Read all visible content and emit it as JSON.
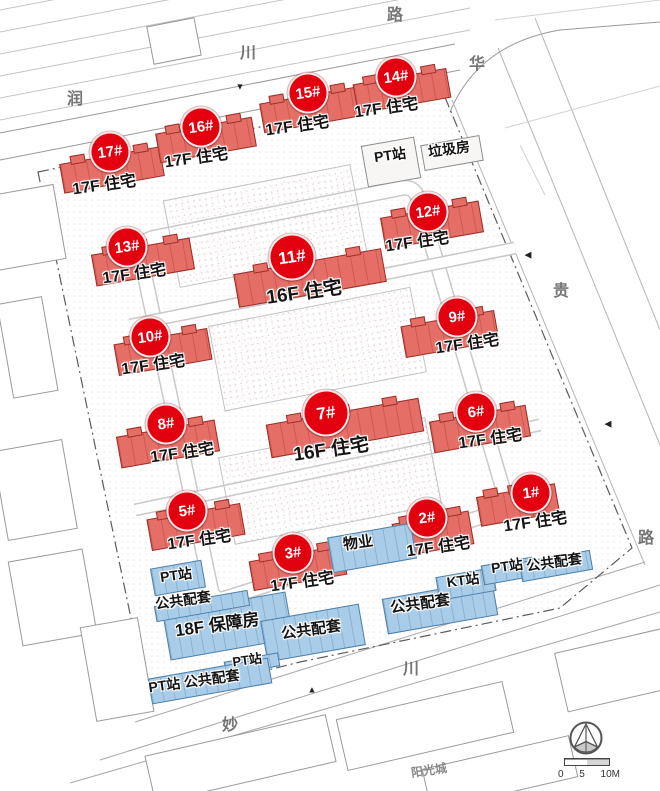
{
  "colors": {
    "badge_red": "#e3000f",
    "building_red_fill": "#e56e67",
    "building_red_border": "#9e2f28",
    "blue_fill": "#a9cde8",
    "blue_border": "#4d80ab",
    "label_ink": "#141414"
  },
  "red_buildings": [
    {
      "id": "17#",
      "floors": "17F 住宅",
      "badge": {
        "x": 110,
        "y": 152
      },
      "label": {
        "x": 104,
        "y": 183
      },
      "rect": {
        "x": 112,
        "y": 170,
        "w": 102,
        "h": 30
      },
      "large": false
    },
    {
      "id": "16#",
      "floors": "17F 住宅",
      "badge": {
        "x": 201,
        "y": 127
      },
      "label": {
        "x": 196,
        "y": 156
      },
      "rect": {
        "x": 206,
        "y": 140,
        "w": 98,
        "h": 30
      },
      "large": false
    },
    {
      "id": "15#",
      "floors": "17F 住宅",
      "badge": {
        "x": 308,
        "y": 93
      },
      "label": {
        "x": 297,
        "y": 124
      },
      "rect": {
        "x": 310,
        "y": 110,
        "w": 98,
        "h": 30
      },
      "large": false
    },
    {
      "id": "14#",
      "floors": "17F 住宅",
      "badge": {
        "x": 396,
        "y": 77
      },
      "label": {
        "x": 386,
        "y": 106
      },
      "rect": {
        "x": 402,
        "y": 91,
        "w": 95,
        "h": 30
      },
      "large": false
    },
    {
      "id": "13#",
      "floors": "17F 住宅",
      "badge": {
        "x": 127,
        "y": 247
      },
      "label": {
        "x": 134,
        "y": 272
      },
      "rect": {
        "x": 143,
        "y": 262,
        "w": 100,
        "h": 32
      },
      "large": false
    },
    {
      "id": "12#",
      "floors": "17F 住宅",
      "badge": {
        "x": 428,
        "y": 212
      },
      "label": {
        "x": 417,
        "y": 240
      },
      "rect": {
        "x": 432,
        "y": 225,
        "w": 100,
        "h": 32
      },
      "large": false
    },
    {
      "id": "11#",
      "floors": "16F 住宅",
      "badge": {
        "x": 292,
        "y": 257
      },
      "label": {
        "x": 304,
        "y": 291
      },
      "rect": {
        "x": 310,
        "y": 278,
        "w": 150,
        "h": 34
      },
      "large": true
    },
    {
      "id": "10#",
      "floors": "17F 住宅",
      "badge": {
        "x": 150,
        "y": 337
      },
      "label": {
        "x": 153,
        "y": 363
      },
      "rect": {
        "x": 163,
        "y": 352,
        "w": 95,
        "h": 32
      },
      "large": false
    },
    {
      "id": "9#",
      "floors": "17F 住宅",
      "badge": {
        "x": 457,
        "y": 317
      },
      "label": {
        "x": 467,
        "y": 342
      },
      "rect": {
        "x": 450,
        "y": 334,
        "w": 95,
        "h": 32
      },
      "large": false
    },
    {
      "id": "8#",
      "floors": "17F 住宅",
      "badge": {
        "x": 166,
        "y": 424
      },
      "label": {
        "x": 182,
        "y": 451
      },
      "rect": {
        "x": 168,
        "y": 444,
        "w": 100,
        "h": 32
      },
      "large": false
    },
    {
      "id": "7#",
      "floors": "16F 住宅",
      "badge": {
        "x": 326,
        "y": 413
      },
      "label": {
        "x": 331,
        "y": 448
      },
      "rect": {
        "x": 345,
        "y": 428,
        "w": 155,
        "h": 34
      },
      "large": true
    },
    {
      "id": "6#",
      "floors": "17F 住宅",
      "badge": {
        "x": 476,
        "y": 412
      },
      "label": {
        "x": 490,
        "y": 437
      },
      "rect": {
        "x": 480,
        "y": 429,
        "w": 98,
        "h": 32
      },
      "large": false
    },
    {
      "id": "5#",
      "floors": "17F 住宅",
      "badge": {
        "x": 187,
        "y": 511
      },
      "label": {
        "x": 199,
        "y": 538
      },
      "rect": {
        "x": 196,
        "y": 527,
        "w": 95,
        "h": 32
      },
      "large": false
    },
    {
      "id": "3#",
      "floors": "17F 住宅",
      "badge": {
        "x": 293,
        "y": 553
      },
      "label": {
        "x": 302,
        "y": 580
      },
      "rect": {
        "x": 298,
        "y": 568,
        "w": 95,
        "h": 30
      },
      "large": false
    },
    {
      "id": "2#",
      "floors": "17F 住宅",
      "badge": {
        "x": 427,
        "y": 518
      },
      "label": {
        "x": 438,
        "y": 545
      },
      "rect": {
        "x": 433,
        "y": 534,
        "w": 78,
        "h": 34
      },
      "large": false
    },
    {
      "id": "1#",
      "floors": "17F 住宅",
      "badge": {
        "x": 531,
        "y": 493
      },
      "label": {
        "x": 535,
        "y": 520
      },
      "rect": {
        "x": 518,
        "y": 505,
        "w": 80,
        "h": 30
      },
      "large": false
    }
  ],
  "blue_buildings": [
    {
      "label": "物业",
      "rect": {
        "x": 372,
        "y": 548,
        "w": 85,
        "h": 36
      },
      "label_pos": {
        "x": 358,
        "y": 542
      },
      "size": 15
    },
    {
      "label": "18F 保障房",
      "rect": {
        "x": 228,
        "y": 626,
        "w": 125,
        "h": 48
      },
      "label_pos": {
        "x": 217,
        "y": 623
      },
      "size": 17
    },
    {
      "label": "公共配套",
      "rect": {
        "x": 313,
        "y": 633,
        "w": 100,
        "h": 42
      },
      "label_pos": {
        "x": 311,
        "y": 629
      },
      "size": 15
    },
    {
      "label": "公共配套",
      "rect": {
        "x": 440,
        "y": 607,
        "w": 112,
        "h": 36
      },
      "label_pos": {
        "x": 420,
        "y": 603
      },
      "size": 15
    },
    {
      "label": "KT站",
      "rect": {
        "x": 466,
        "y": 584,
        "w": 58,
        "h": 24
      },
      "label_pos": {
        "x": 463,
        "y": 580
      },
      "size": 14
    },
    {
      "label": "PT站",
      "rect": {
        "x": 508,
        "y": 571,
        "w": 52,
        "h": 20
      },
      "label_pos": {
        "x": 507,
        "y": 566
      },
      "size": 14
    },
    {
      "label": "公共配套",
      "rect": {
        "x": 556,
        "y": 566,
        "w": 72,
        "h": 20
      },
      "label_pos": {
        "x": 554,
        "y": 562
      },
      "size": 14
    },
    {
      "label": "PT站",
      "rect": {
        "x": 178,
        "y": 578,
        "w": 52,
        "h": 28
      },
      "label_pos": {
        "x": 176,
        "y": 575
      },
      "size": 14
    },
    {
      "label": "公共配套",
      "rect": {
        "x": 202,
        "y": 606,
        "w": 95,
        "h": 16
      },
      "label_pos": {
        "x": 183,
        "y": 600
      },
      "size": 14
    },
    {
      "label": "PT站",
      "rect": {
        "x": 252,
        "y": 664,
        "w": 55,
        "h": 14
      },
      "label_pos": {
        "x": 247,
        "y": 659
      },
      "size": 13
    },
    {
      "label": "PT站 公共配套",
      "rect": {
        "x": 210,
        "y": 681,
        "w": 122,
        "h": 26
      },
      "label_pos": {
        "x": 194,
        "y": 681
      },
      "size": 14
    }
  ],
  "white_facilities": [
    {
      "label": "PT站",
      "rect": {
        "x": 391,
        "y": 162,
        "w": 54,
        "h": 42
      },
      "label_pos": {
        "x": 390,
        "y": 155
      },
      "size": 14
    },
    {
      "label": "垃圾房",
      "rect": {
        "x": 452,
        "y": 153,
        "w": 60,
        "h": 26
      },
      "label_pos": {
        "x": 449,
        "y": 149
      },
      "size": 14
    }
  ],
  "road_labels": [
    {
      "ch": "润",
      "x": 75,
      "y": 97
    },
    {
      "ch": "川",
      "x": 248,
      "y": 51
    },
    {
      "ch": "路",
      "x": 395,
      "y": 13
    },
    {
      "ch": "华",
      "x": 477,
      "y": 62
    },
    {
      "ch": "贵",
      "x": 561,
      "y": 289
    },
    {
      "ch": "路",
      "x": 646,
      "y": 536
    },
    {
      "ch": "川",
      "x": 411,
      "y": 667
    },
    {
      "ch": "妙",
      "x": 230,
      "y": 723
    }
  ],
  "misc_labels": [
    {
      "text": "阳光城",
      "x": 429,
      "y": 770,
      "size": 12
    }
  ],
  "entrances": [
    {
      "x": 240,
      "y": 87,
      "glyph": "▼"
    },
    {
      "x": 528,
      "y": 255,
      "glyph": "◀"
    },
    {
      "x": 608,
      "y": 424,
      "glyph": "◀"
    },
    {
      "x": 312,
      "y": 690,
      "glyph": "▲"
    }
  ],
  "scalebar": {
    "t0": "0",
    "t1": "5",
    "t2": "10M"
  }
}
